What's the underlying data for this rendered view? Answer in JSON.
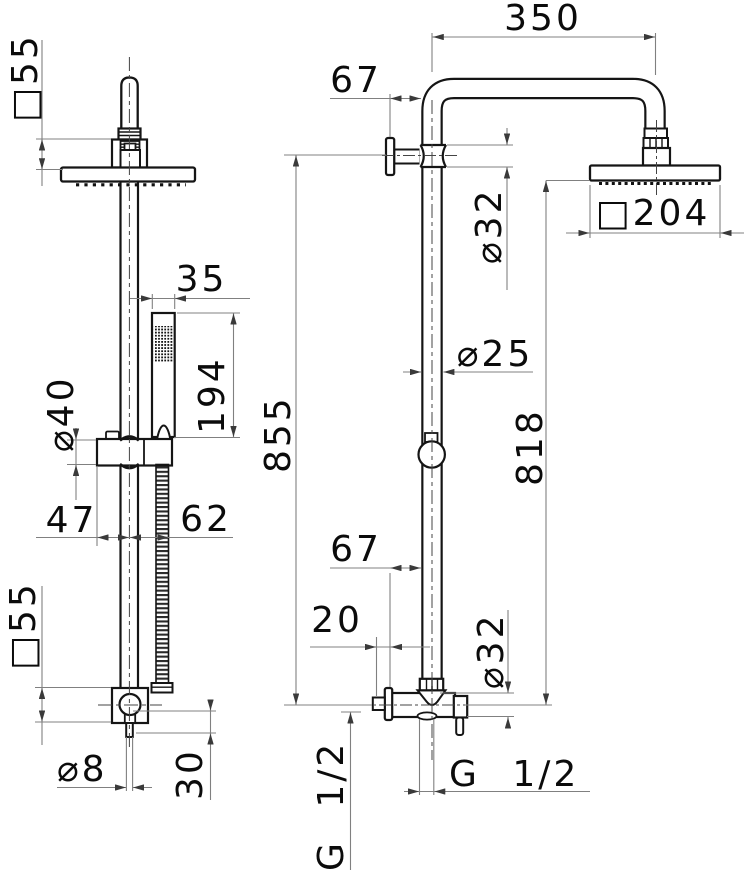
{
  "colors": {
    "line": "#151515",
    "dimension": "#808080",
    "text": "#0b0b0b",
    "background": "#ffffff"
  },
  "front": {
    "square_55_top": "□55",
    "hand_shower_width_35": "35",
    "hand_shower_length_194": "194",
    "slider_dia_40": "⌀40",
    "offset_47": "47",
    "offset_62": "62",
    "square_55_bottom": "□55",
    "outlet_dia_8": "⌀8",
    "outlet_length_30": "30"
  },
  "side": {
    "arm_reach_350": "350",
    "wall_offset_67_top": "67",
    "pipe_dia_32_top": "⌀32",
    "head_square_204": "□204",
    "column_dia_25": "⌀25",
    "total_height_855": "855",
    "head_height_818": "818",
    "wall_offset_67_bottom": "67",
    "wall_depth_20": "20",
    "valve_dia_32_bottom": "⌀32",
    "outlet_thread": "G 1/2",
    "inlet_thread": "G 1/2"
  }
}
